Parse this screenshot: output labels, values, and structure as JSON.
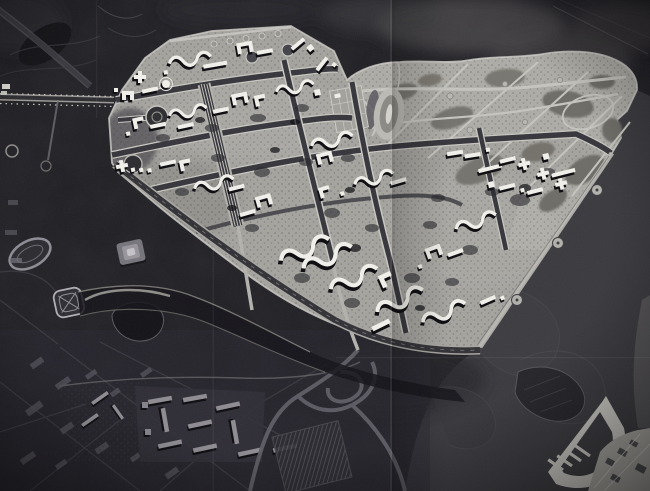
{
  "figure": {
    "type": "black-and-white photograph",
    "subject": "urban master plan model of a riverside city district",
    "alt": "Monochrome aerial-view master plan photograph: light residential superblocks with white model buildings and a large landscaped park peninsula, surrounded by dark water with sandbanks, a comb-shaped pier at lower right, and darker existing city fabric at lower left",
    "visible_text": "none"
  },
  "palette": {
    "background": "#1f1e23",
    "plate": "#a5a39e",
    "park": "#aeaca6",
    "park_grove": "#75736d",
    "water": "#3b3a3f",
    "water_deep": "#2a292e",
    "canal": "#15141a",
    "road_dark": "#36353b",
    "road_edge": "#d2d0ca",
    "building_white": "#f2f0ea",
    "shadow_black": "#0b0a0e",
    "city_dark": "#26252c",
    "city_line": "#45444c",
    "slab_gray": "#8e8c92",
    "pier_light": "#cbc9c3",
    "shore": "#aeaca7",
    "crease_light": "#d6d4d0"
  },
  "regions": {
    "top_left": "dark terrain with faint country roads",
    "top_right": "smoky dark background above park peninsula",
    "center": "planned residential superblocks with white model buildings",
    "park": "landscaped park with winding paths and oval stadium",
    "southwest": "existing city fabric with running track and arena",
    "bottom_center": "slab housing and highway interchange",
    "river": "dark river with sandbank contours",
    "pier": "comb-shaped pier structure",
    "bottom_right_shore": "opposite shore with small blocks",
    "creases": "photograph fold creases"
  }
}
